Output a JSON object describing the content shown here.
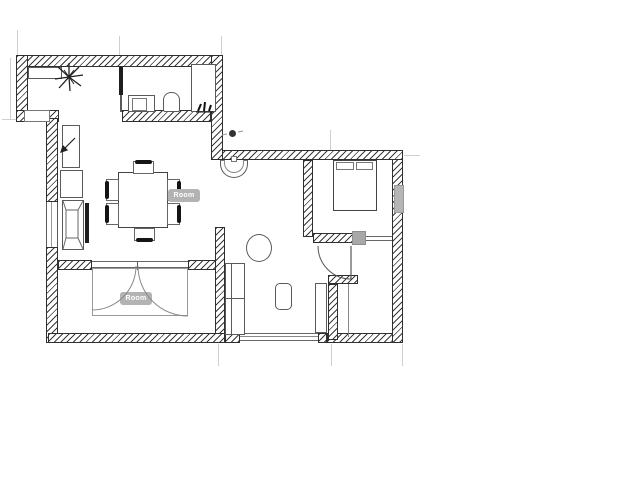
{
  "app": {
    "type": "floor-plan-drawing"
  },
  "floorplan": {
    "labels": {
      "dining_room": "Room",
      "second_room": "Room"
    },
    "colors": {
      "background": "#ffffff",
      "wall_line": "#2f2f2f",
      "furniture_line": "#5a5a5a",
      "badge_bg": "#b3b3b3",
      "badge_text": "#ffffff",
      "column_gray": "#a8a8a8",
      "radiator_gray": "#b5b5b5",
      "dimension_line": "#cfcfcf"
    },
    "rooms": [
      {
        "name": "entry-hall",
        "furniture": [
          "wall-shelf",
          "potted-plant"
        ]
      },
      {
        "name": "bathroom",
        "furniture": [
          "sink-cabinet",
          "toilet",
          "shower-cabin"
        ]
      },
      {
        "name": "dining-kitchen",
        "badge": "Room",
        "furniture": [
          "refrigerator",
          "cabinet",
          "armchair-unit",
          "tv-panel",
          "dining-table",
          "six-chairs",
          "wall-basin",
          "ceiling-light"
        ]
      },
      {
        "name": "bedroom",
        "furniture": [
          "double-bed",
          "radiator",
          "swing-door"
        ]
      },
      {
        "name": "second-room",
        "badge": "Room",
        "furniture": [
          "wardrobe-double-doors"
        ]
      },
      {
        "name": "living-area",
        "furniture": [
          "sofa",
          "round-table",
          "coffee-table",
          "closet-niche",
          "window-slider"
        ]
      }
    ]
  }
}
